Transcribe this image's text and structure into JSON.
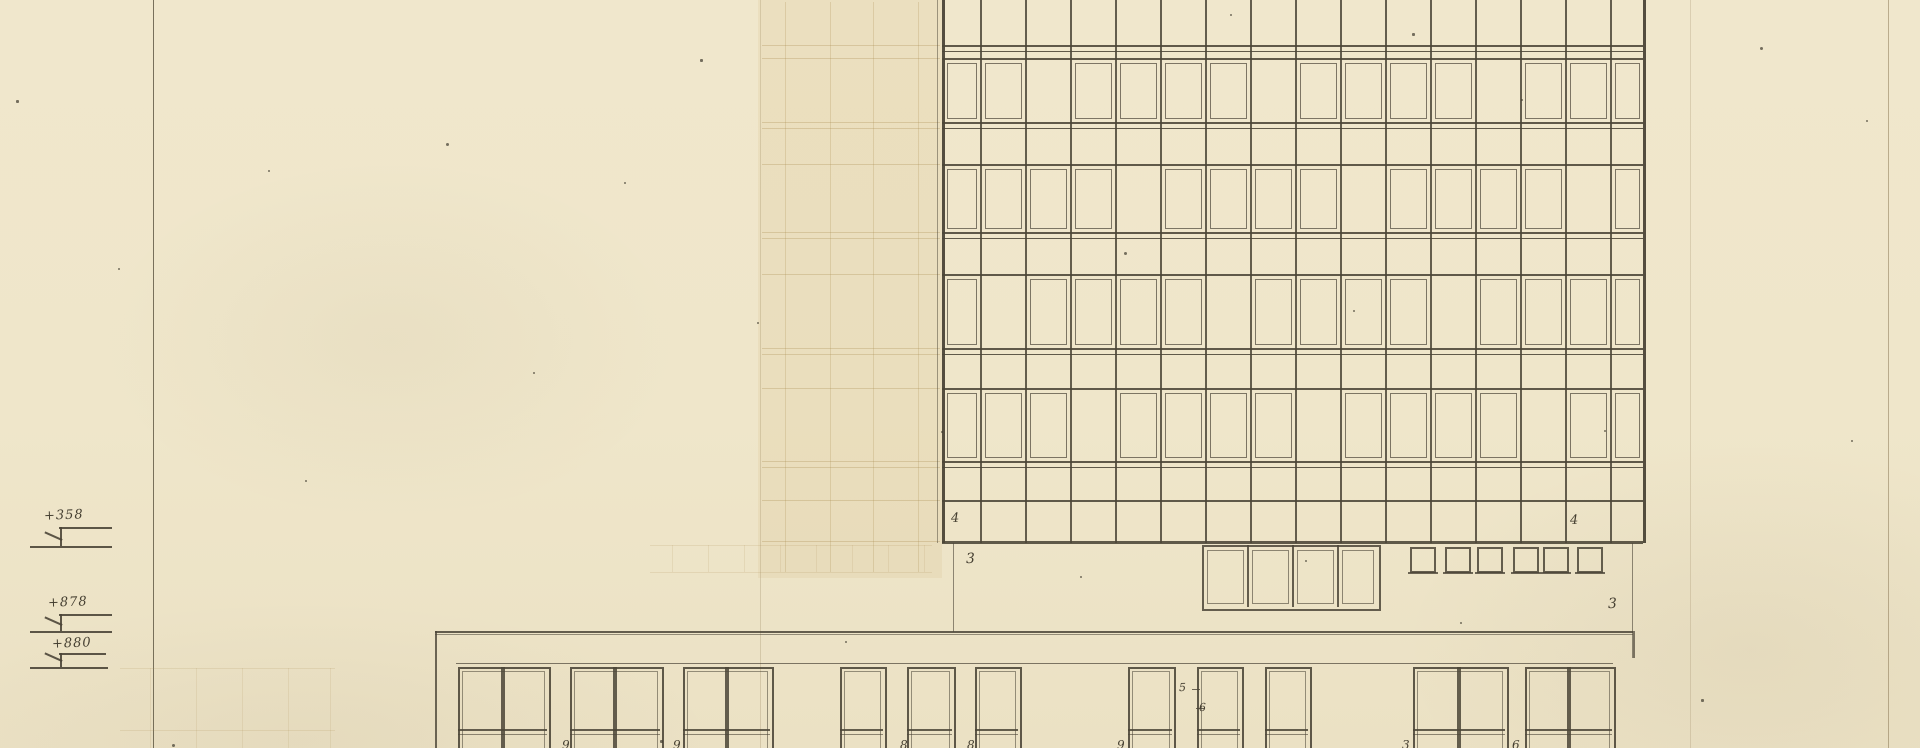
{
  "sheet": {
    "width": 1920,
    "height": 748,
    "paper_color": "#efe6ca",
    "ink_color": "#4b4537",
    "ghost_line_color": "rgba(170,140,80,0.30)",
    "description": "scanned architectural elevation drawing"
  },
  "elevation_markers": [
    {
      "label": "+358",
      "bar": {
        "x1": 59,
        "x2": 112,
        "y": 527
      },
      "stem": {
        "x": 60,
        "y1": 527,
        "y2": 546
      },
      "base": {
        "x1": 30,
        "x2": 112,
        "y": 546
      }
    },
    {
      "label": "+878",
      "bar": {
        "x1": 59,
        "x2": 112,
        "y": 614
      },
      "stem": {
        "x": 60,
        "y1": 614,
        "y2": 631
      },
      "base": {
        "x1": 30,
        "x2": 112,
        "y": 631
      }
    },
    {
      "label": "+880",
      "bar": {
        "x1": 59,
        "x2": 106,
        "y": 653
      },
      "stem": {
        "x": 60,
        "y1": 653,
        "y2": 667
      },
      "base": {
        "x1": 30,
        "x2": 108,
        "y": 667
      }
    }
  ],
  "annotations": {
    "floor_left": "4",
    "floor_right": "4",
    "ground_left": "3",
    "ground_right": "3",
    "detail_top": "5",
    "detail_bottom": "6"
  },
  "facade": {
    "left": 942,
    "right": 1643,
    "top": 0,
    "bottom": 543,
    "cols": [
      942,
      980,
      1025,
      1070,
      1115,
      1160,
      1205,
      1250,
      1295,
      1340,
      1385,
      1430,
      1475,
      1520,
      1565,
      1610,
      1643
    ],
    "hlines": [
      {
        "y": 45,
        "w": 2
      },
      {
        "y": 51,
        "w": 1
      },
      {
        "y": 58,
        "w": 2
      },
      {
        "y": 122,
        "w": 2
      },
      {
        "y": 128,
        "w": 1
      },
      {
        "y": 164,
        "w": 2
      },
      {
        "y": 232,
        "w": 2
      },
      {
        "y": 238,
        "w": 1
      },
      {
        "y": 274,
        "w": 2
      },
      {
        "y": 348,
        "w": 2
      },
      {
        "y": 354,
        "w": 1
      },
      {
        "y": 388,
        "w": 2
      },
      {
        "y": 461,
        "w": 2
      },
      {
        "y": 467,
        "w": 1
      },
      {
        "y": 500,
        "w": 2
      },
      {
        "y": 541,
        "w": 3
      }
    ],
    "window_rows": [
      {
        "y": 60,
        "h": 60
      },
      {
        "y": 166,
        "h": 64
      },
      {
        "y": 276,
        "h": 70
      },
      {
        "y": 390,
        "h": 69
      }
    ]
  },
  "below_facade": {
    "drop_left": {
      "x": 953,
      "y1": 543,
      "y2": 632
    },
    "drop_right": {
      "x": 1632,
      "y1": 543,
      "y2": 658
    },
    "entrance": {
      "x": 1202,
      "right": 1377,
      "top": 545,
      "bottom": 607,
      "cols": [
        1202,
        1247,
        1292,
        1337,
        1377
      ]
    },
    "squares": {
      "y": 547,
      "size": 22,
      "xs": [
        1410,
        1445,
        1477,
        1513,
        1543,
        1577
      ]
    }
  },
  "lower_building": {
    "top_line": {
      "y": 631,
      "x1": 435,
      "x2": 1633
    },
    "left_wall": {
      "x": 435,
      "y1": 631,
      "y2": 748
    },
    "lintel": {
      "y": 663,
      "x1": 456,
      "x2": 1613
    },
    "window_top": 667,
    "transom_y": 729,
    "windows": [
      {
        "x": 458,
        "w": 89,
        "pair": true
      },
      {
        "x": 570,
        "w": 90,
        "pair": true
      },
      {
        "x": 683,
        "w": 87,
        "pair": true
      },
      {
        "x": 840,
        "w": 43,
        "pair": false
      },
      {
        "x": 907,
        "w": 45,
        "pair": false
      },
      {
        "x": 975,
        "w": 43,
        "pair": false
      },
      {
        "x": 1128,
        "w": 44,
        "pair": false
      },
      {
        "x": 1197,
        "w": 43,
        "pair": false
      },
      {
        "x": 1265,
        "w": 43,
        "pair": false
      },
      {
        "x": 1413,
        "w": 92,
        "pair": true
      },
      {
        "x": 1525,
        "w": 87,
        "pair": true
      }
    ]
  },
  "bottom_digits": [
    {
      "x": 562,
      "v": "9"
    },
    {
      "x": 673,
      "v": "9"
    },
    {
      "x": 900,
      "v": "8"
    },
    {
      "x": 967,
      "v": "8"
    },
    {
      "x": 1117,
      "v": "9"
    },
    {
      "x": 1402,
      "v": "3"
    },
    {
      "x": 1512,
      "v": "6"
    }
  ],
  "folds": [
    {
      "x": 153,
      "color": "rgba(90,82,62,0.8)",
      "w": 1
    },
    {
      "x": 760,
      "color": "rgba(140,120,80,0.25)",
      "w": 1
    },
    {
      "x": 1690,
      "color": "rgba(140,120,80,0.22)",
      "w": 1
    },
    {
      "x": 1888,
      "color": "rgba(120,100,65,0.45)",
      "w": 1
    }
  ],
  "ghosts": {
    "facade_region": {
      "x": 758,
      "y": 0,
      "w": 184,
      "h": 578,
      "bg": "rgba(206,175,112,0.14)",
      "h_ys": [
        45,
        58,
        122,
        128,
        164,
        232,
        238,
        274,
        348,
        354,
        388,
        461,
        467,
        500,
        541
      ],
      "v_xs": [
        785,
        830,
        873,
        918
      ]
    },
    "mid_row": {
      "x": 650,
      "y": 543,
      "w": 282,
      "h_ys": [
        545,
        572
      ],
      "v_xs": [
        672,
        708,
        744,
        780,
        816,
        852,
        888,
        924
      ]
    },
    "lower_left": {
      "x": 120,
      "y": 660,
      "w": 215,
      "h_ys": [
        668,
        730
      ],
      "v_xs": [
        150,
        196,
        242,
        288,
        330
      ]
    }
  },
  "specks": [
    [
      16,
      100
    ],
    [
      118,
      268
    ],
    [
      268,
      170
    ],
    [
      446,
      143
    ],
    [
      533,
      372
    ],
    [
      624,
      182
    ],
    [
      700,
      59
    ],
    [
      757,
      322
    ],
    [
      941,
      431
    ],
    [
      1124,
      252
    ],
    [
      1230,
      14
    ],
    [
      1353,
      310
    ],
    [
      1412,
      33
    ],
    [
      1521,
      99
    ],
    [
      1604,
      430
    ],
    [
      1760,
      47
    ],
    [
      1851,
      440
    ],
    [
      1460,
      622
    ],
    [
      1701,
      699
    ],
    [
      845,
      641
    ],
    [
      305,
      480
    ],
    [
      172,
      744
    ],
    [
      1866,
      120
    ],
    [
      1080,
      576
    ],
    [
      660,
      740
    ],
    [
      1305,
      560
    ]
  ]
}
